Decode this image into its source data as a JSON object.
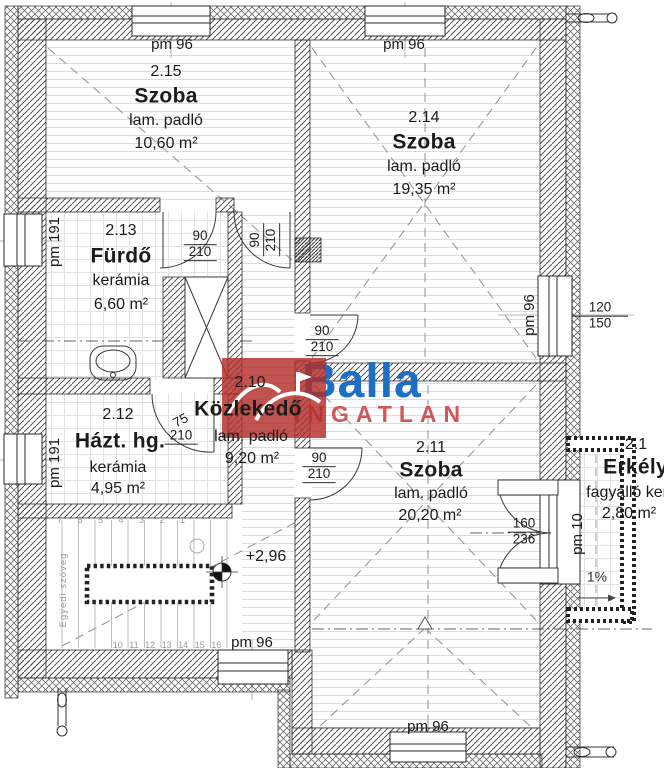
{
  "logo": {
    "brand": "Balla",
    "suffix": "INGATLAN"
  },
  "rooms": [
    {
      "id": "2.15",
      "name": "Szoba",
      "floor": "lam. padló",
      "area": "10,60 m²"
    },
    {
      "id": "2.14",
      "name": "Szoba",
      "floor": "lam. padló",
      "area": "19,35 m²"
    },
    {
      "id": "2.13",
      "name": "Fürdő",
      "floor": "kerámia",
      "area": "6,60 m²"
    },
    {
      "id": "2.10",
      "name": "Közlekedő",
      "floor": "lam. padló",
      "area": "9,20 m²"
    },
    {
      "id": "2.12",
      "name": "Házt. hg.",
      "floor": "kerámia",
      "area": "4,95 m²"
    },
    {
      "id": "2.11",
      "name": "Szoba",
      "floor": "lam. padló",
      "area": "20,20 m²"
    },
    {
      "id": "2.1",
      "name": "Erkély",
      "floor": "fagyálló ker",
      "area": "2,80 m²"
    }
  ],
  "labels": {
    "pm96": "pm 96",
    "pm191": "pm 191",
    "pm10": "pm 10",
    "level": "+2,96",
    "slope": "1%",
    "custom_text": "Egyedi szöveg",
    "stairs_top": "7 6 5 4 3 2 1",
    "stairs_bottom": "10 11 12 13 14 15 16"
  },
  "dims": {
    "d90": "90",
    "d210": "210",
    "d75": "75",
    "d160": "160",
    "d236": "236",
    "w120": "120",
    "w150": "150"
  }
}
